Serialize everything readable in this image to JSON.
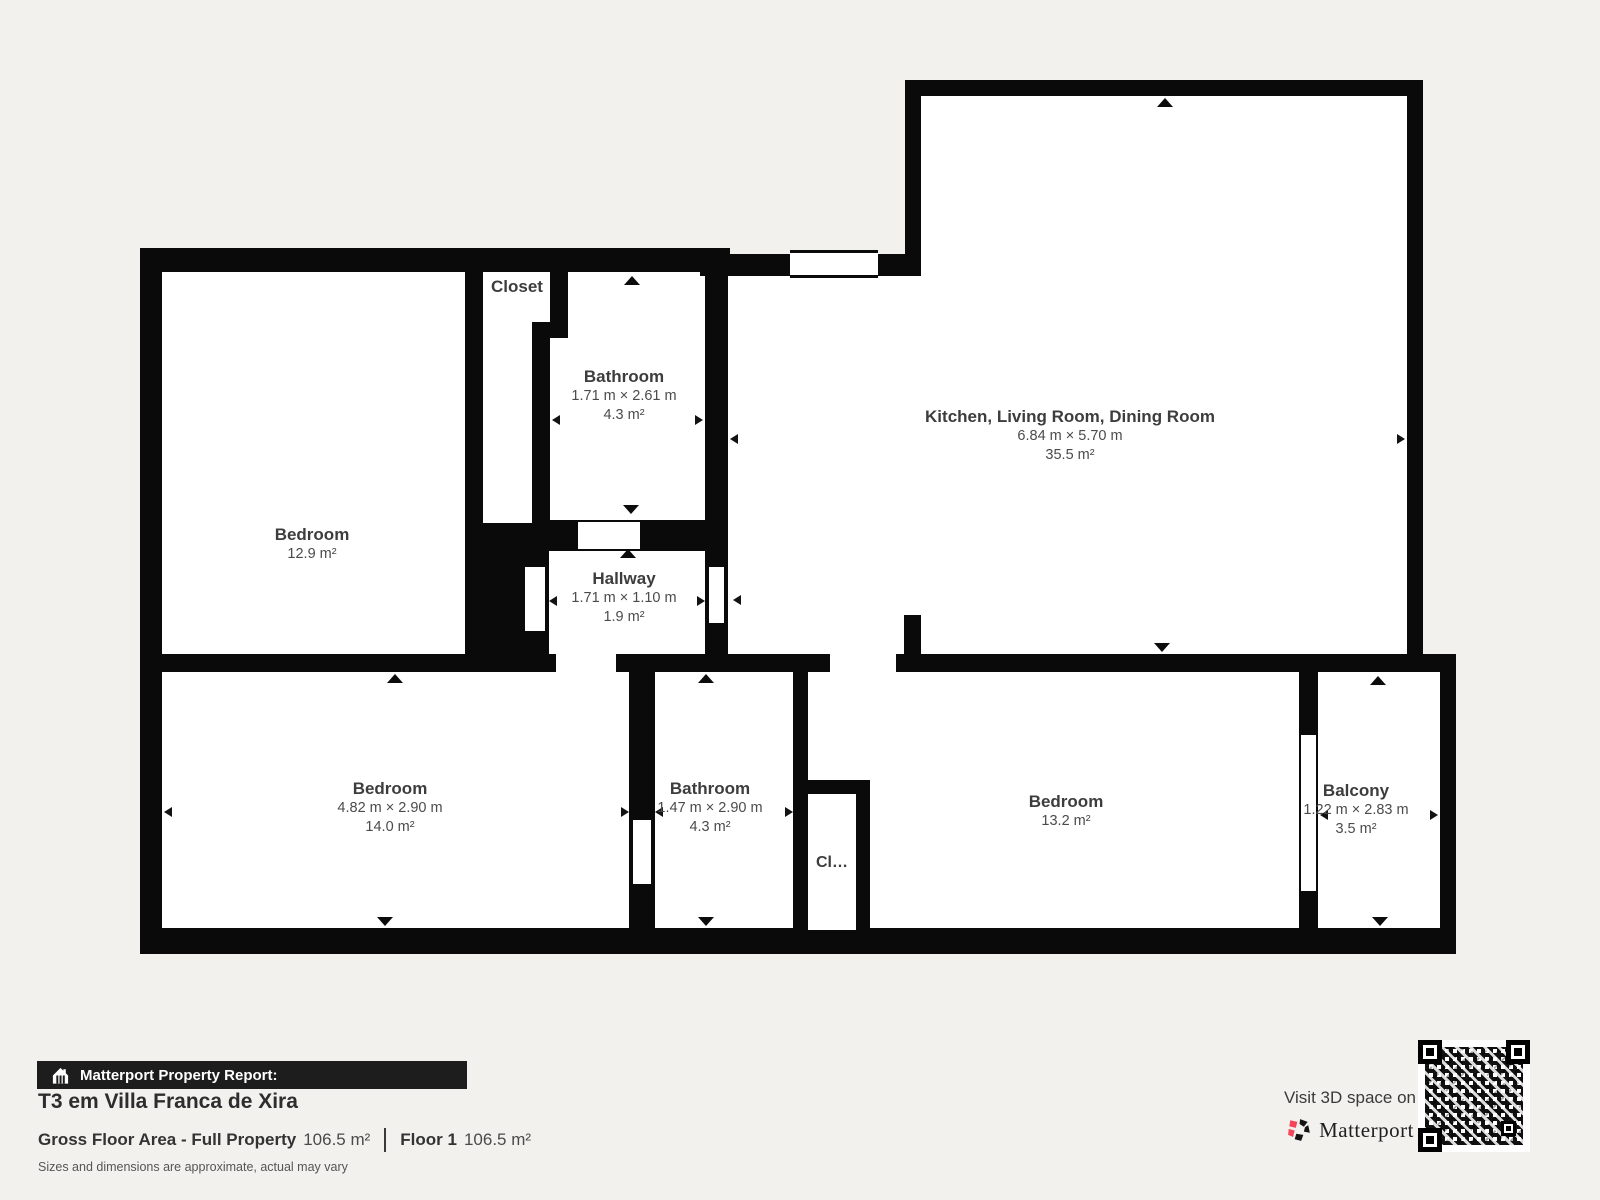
{
  "plan": {
    "rooms": [
      {
        "name": "Closet"
      },
      {
        "name": "Bathroom",
        "dims": "1.71 m × 2.61 m",
        "area": "4.3 m²"
      },
      {
        "name": "Kitchen, Living Room, Dining Room",
        "dims": "6.84 m × 5.70 m",
        "area": "35.5 m²"
      },
      {
        "name": "Bedroom",
        "area": "12.9 m²"
      },
      {
        "name": "Hallway",
        "dims": "1.71 m × 1.10 m",
        "area": "1.9 m²"
      },
      {
        "name": "Bedroom",
        "dims": "4.82 m × 2.90 m",
        "area": "14.0 m²"
      },
      {
        "name": "Bathroom",
        "dims": "1.47 m × 2.90 m",
        "area": "4.3 m²"
      },
      {
        "name": "Cl…"
      },
      {
        "name": "Bedroom",
        "area": "13.2 m²"
      },
      {
        "name": "Balcony",
        "dims": "1.22 m × 2.83 m",
        "area": "3.5 m²"
      }
    ]
  },
  "footer": {
    "report_label": "Matterport Property Report:",
    "property_title": "T3 em Villa Franca de Xira",
    "gross_label": "Gross Floor Area - Full Property",
    "gross_value": "106.5 m²",
    "floor_label": "Floor 1",
    "floor_value": "106.5 m²",
    "disclaimer": "Sizes and dimensions are approximate, actual may vary"
  },
  "cta": {
    "visit_text": "Visit 3D space on",
    "brand": "Matterport"
  },
  "icons": {
    "report_bar": "house-icon",
    "brand_mark": "matterport-pinwheel-icon",
    "qr": "qr-code"
  },
  "colors": {
    "background": "#f2f1ee",
    "wall": "#0a0a0a",
    "floor": "#ffffff",
    "accent_pink": "#f4455a",
    "bar": "#1d1d1d"
  }
}
